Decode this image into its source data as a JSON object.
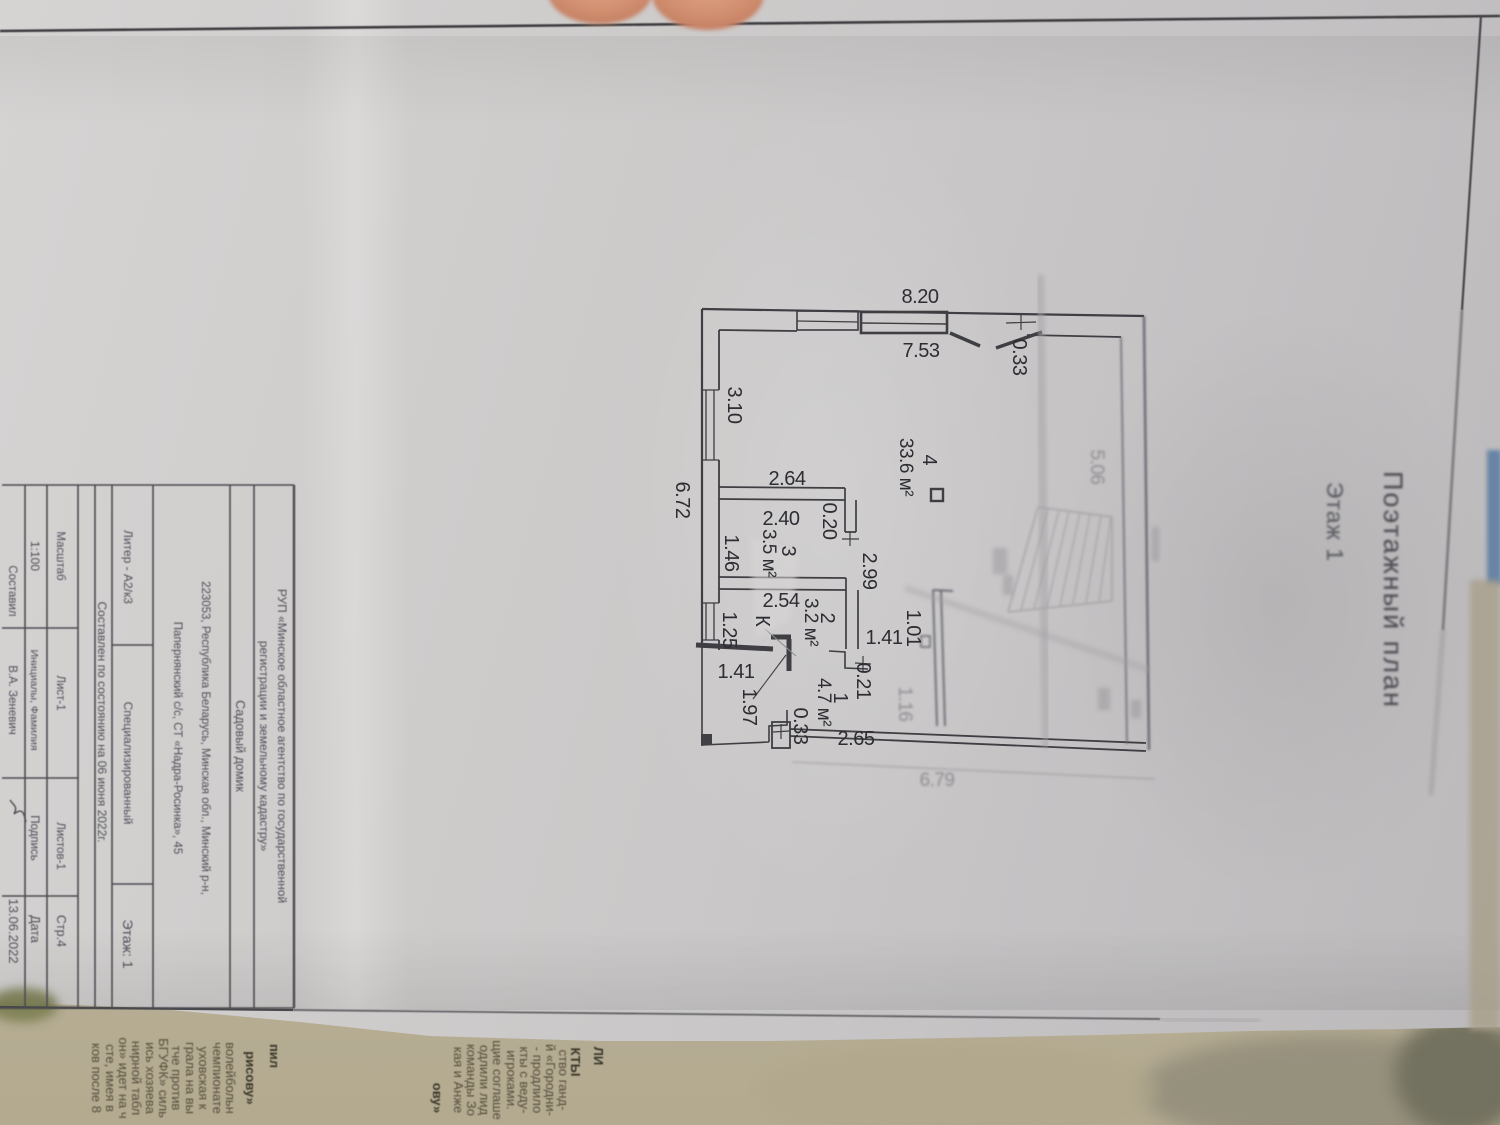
{
  "header": {
    "title": "Поэтажный план",
    "subtitle": "Этаж 1"
  },
  "plan": {
    "dims_h": [
      "8.20",
      "7.53",
      "2.64",
      "2.40",
      "2.54",
      "1.41",
      "1.41",
      "2.65",
      "6.79"
    ],
    "dims_v": [
      "0.33",
      "3.10",
      "6.72",
      "0.20",
      "1.46",
      "2.99",
      "1.25",
      "0.21",
      "1.97",
      "0.33",
      "1.01",
      "1.16",
      "5.06"
    ],
    "rooms": [
      {
        "number": "4",
        "area": "33.6 м²"
      },
      {
        "number": "3",
        "area": "3.5 м²"
      },
      {
        "number": "2",
        "area": "3.2 м²"
      },
      {
        "number": "1",
        "area": "4.7 м²"
      }
    ],
    "boiler_symbol": "К"
  },
  "title_block": {
    "org_line1": "РУП «Минское областное агентство по государственной",
    "org_line2": "регистрации и земельному кадастру»",
    "object_type": "Садовый домик",
    "address_line1": "223053, Республика Беларусь, Минская обл., Минский р-н,",
    "address_line2": "Папернянский с/с, СТ «Надра-Росинка», 45",
    "liter": "Литер - А2/к3",
    "specialized": "Специализированный",
    "floor": "Этаж: 1",
    "as_of": "Составлен по состоянию на  06 июня 2022г.",
    "scale_label": "Масштаб",
    "sheet": "Лист-1",
    "sheets": "Листов-1",
    "page": "Стр.4",
    "scale_value": "1:100",
    "name_header": "Инициалы, Фамилия",
    "signature_header": "Подпись",
    "date_header": "Дата",
    "compiled_by": "Составил",
    "compiler_name": "В.А. Зеневич",
    "date_value": "13.06.2022"
  },
  "newspaper": {
    "left_block": {
      "headline_a": "пил",
      "headline_b": "рисову»",
      "lines": [
        "волейбольн",
        "чемпионате",
        "уховская к",
        "грала на вы",
        "тче против",
        "БГУФК» силь",
        "ись хозяева",
        "нирной табл",
        "он» идет на ч",
        "сте, имея в",
        "ков после 8"
      ]
    },
    "mid_block": {
      "headline_a": "ЛИ",
      "headline_b": "КТЫ",
      "headline_c": "ову»",
      "lines": [
        "ство ганд-",
        "й «Городни-",
        "- продлило",
        "кты с веду-",
        "игроками.",
        "щие соглаше",
        "одлили лид",
        "команды Зо",
        "кая и Анже"
      ]
    }
  }
}
